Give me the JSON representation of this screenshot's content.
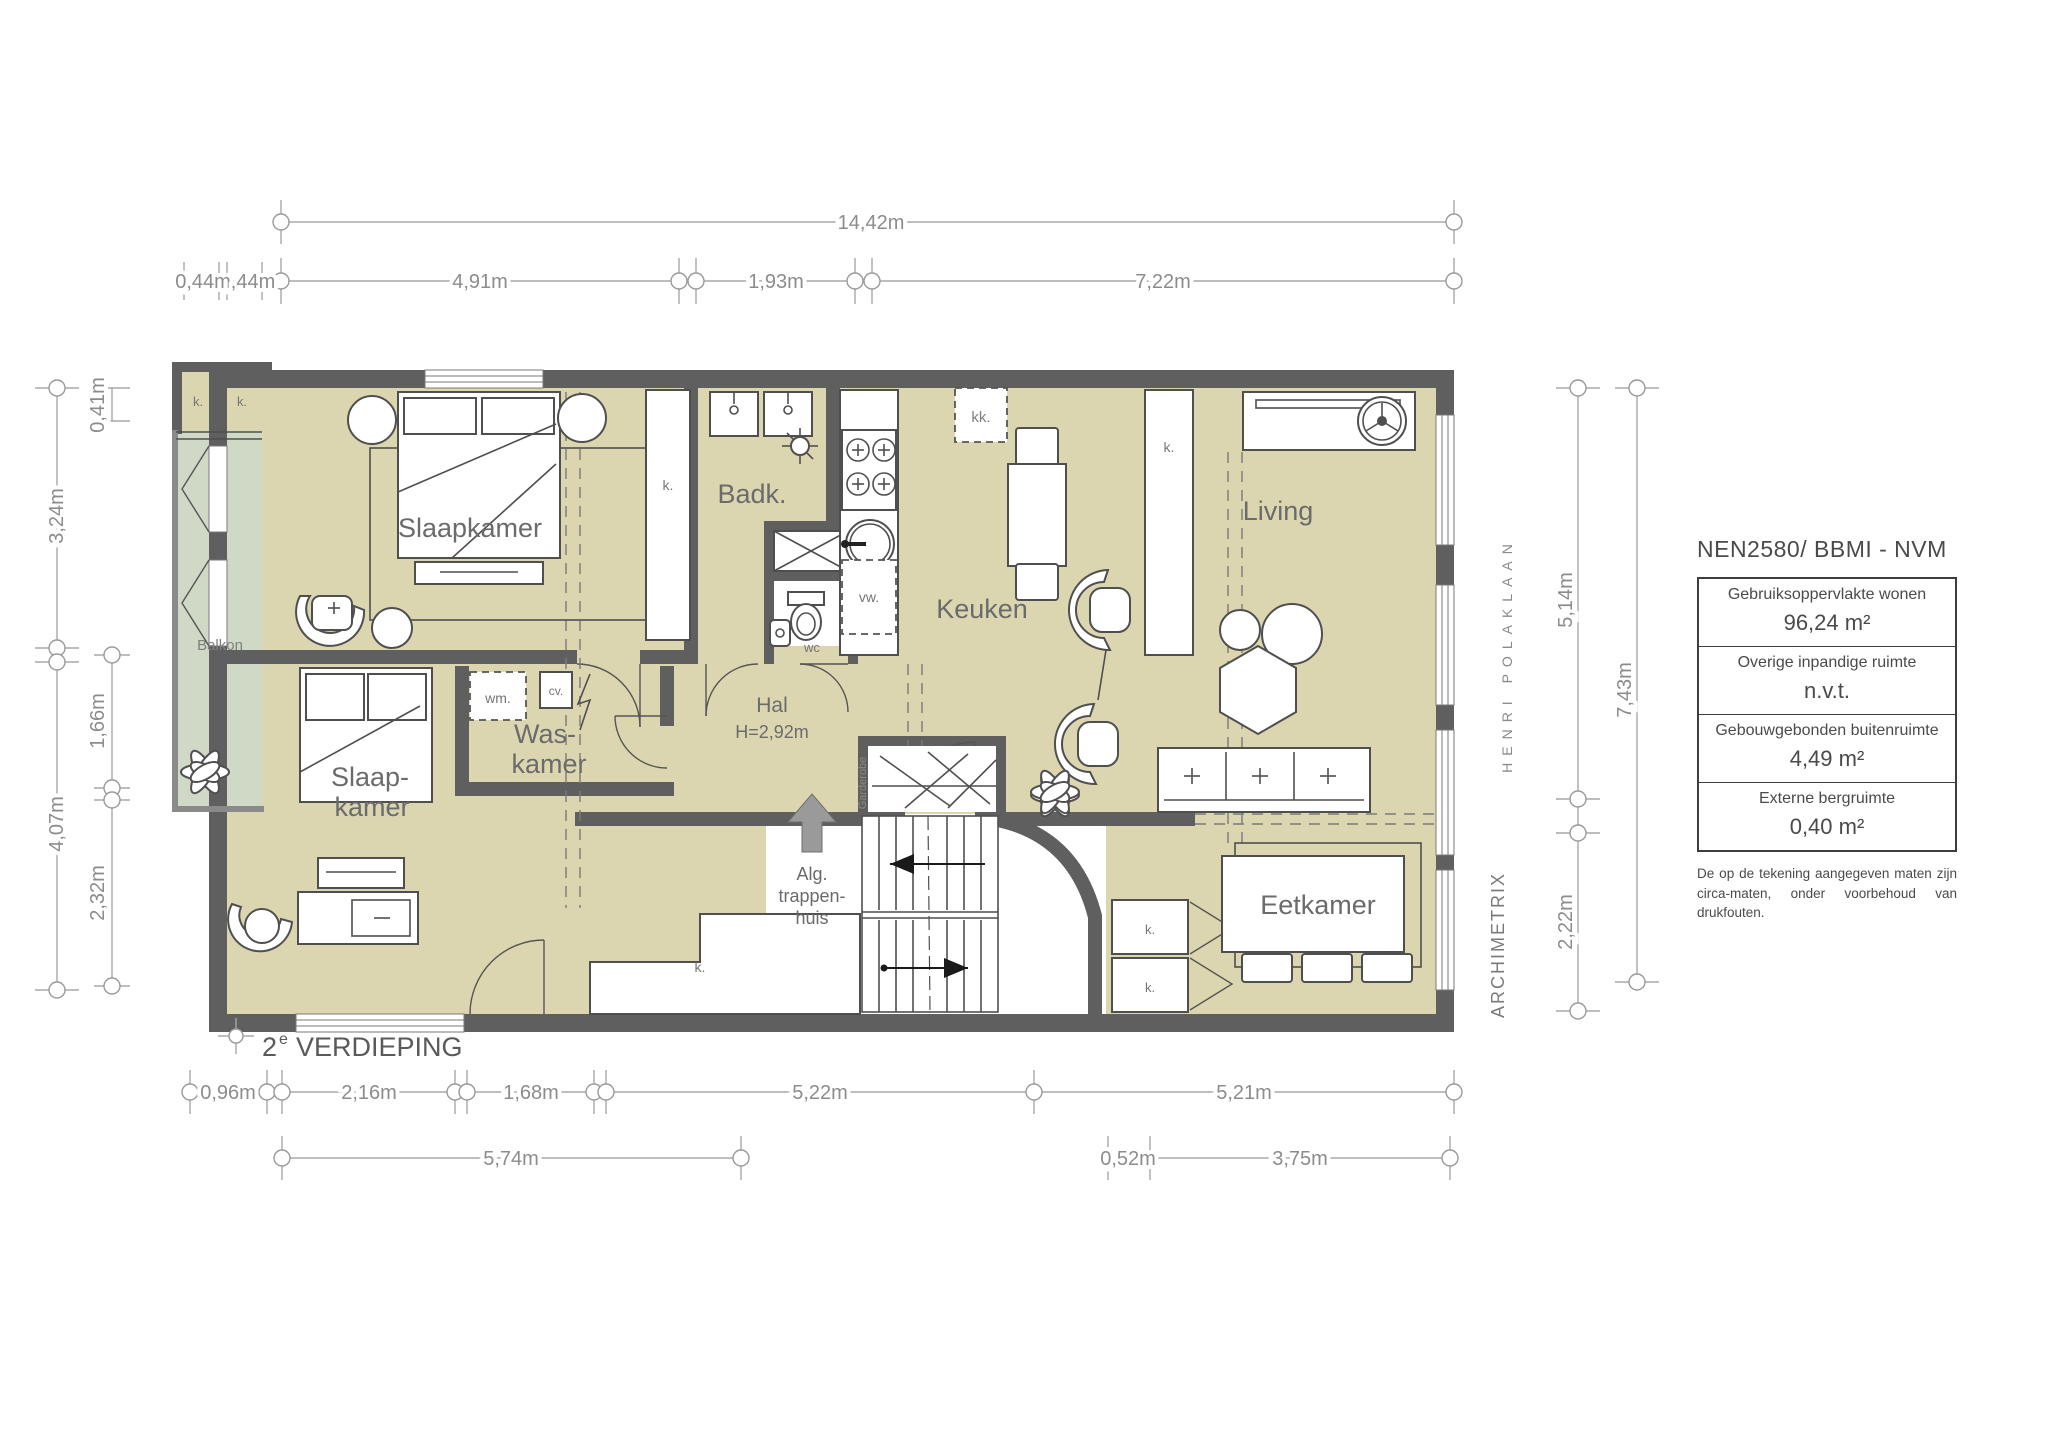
{
  "floor_title": {
    "number": "2",
    "superscript": "e",
    "text": "VERDIEPING"
  },
  "rooms": {
    "bedroom1": "Slaapkamer",
    "bathroom": "Badk.",
    "kitchen": "Keuken",
    "living": "Living",
    "bedroom2_line1": "Slaap-",
    "bedroom2_line2": "kamer",
    "laundry_line1": "Was-",
    "laundry_line2": "kamer",
    "hall": "Hal",
    "hall_height": "H=2,92m",
    "balcony": "Balkon",
    "dining": "Eetkamer",
    "stairwell_line1": "Alg.",
    "stairwell_line2": "trappen-",
    "stairwell_line3": "huis",
    "wardrobe": "Garderobe",
    "toilet": "wc"
  },
  "fixtures": {
    "closet": "k.",
    "fridge": "kk.",
    "washer": "wm.",
    "boiler": "cv.",
    "dishwasher": "vw."
  },
  "dimensions": {
    "top_total": "14,42m",
    "top_segments": [
      "0,44m",
      ",44m",
      "4,91m",
      "1,93m",
      "7,22m"
    ],
    "left_outer": [
      "3,24m",
      "4,07m"
    ],
    "left_inner": [
      "0,41m",
      "1,66m",
      "2,32m"
    ],
    "right_inner": [
      "5,14m",
      "2,22m"
    ],
    "right_outer": "7,43m",
    "bottom_row1": [
      "0,96m",
      "2,16m",
      "1,68m",
      "5,22m",
      "5,21m"
    ],
    "bottom_row2": [
      "5,74m",
      "0,52m",
      "3,75m"
    ]
  },
  "side_texts": {
    "street": "HENRI POLAKLAAN",
    "brand": "ARCHIMETRIX"
  },
  "legend": {
    "title": "NEN2580/ BBMI - NVM",
    "rows": [
      {
        "label": "Gebruiksoppervlakte wonen",
        "value": "96,24 m²"
      },
      {
        "label": "Overige inpandige ruimte",
        "value": "n.v.t."
      },
      {
        "label": "Gebouwgebonden buitenruimte",
        "value": "4,49 m²"
      },
      {
        "label": "Externe bergruimte",
        "value": "0,40 m²"
      }
    ],
    "disclaimer": "De op de tekening aangegeven maten zijn circa-maten, onder voorbehoud van drukfouten."
  },
  "colors": {
    "floor": "#dcd6b0",
    "balcony": "#cfd9c6",
    "wall": "#5f5f5f",
    "dim": "#9e9e9e",
    "label": "#6b6b6b"
  }
}
